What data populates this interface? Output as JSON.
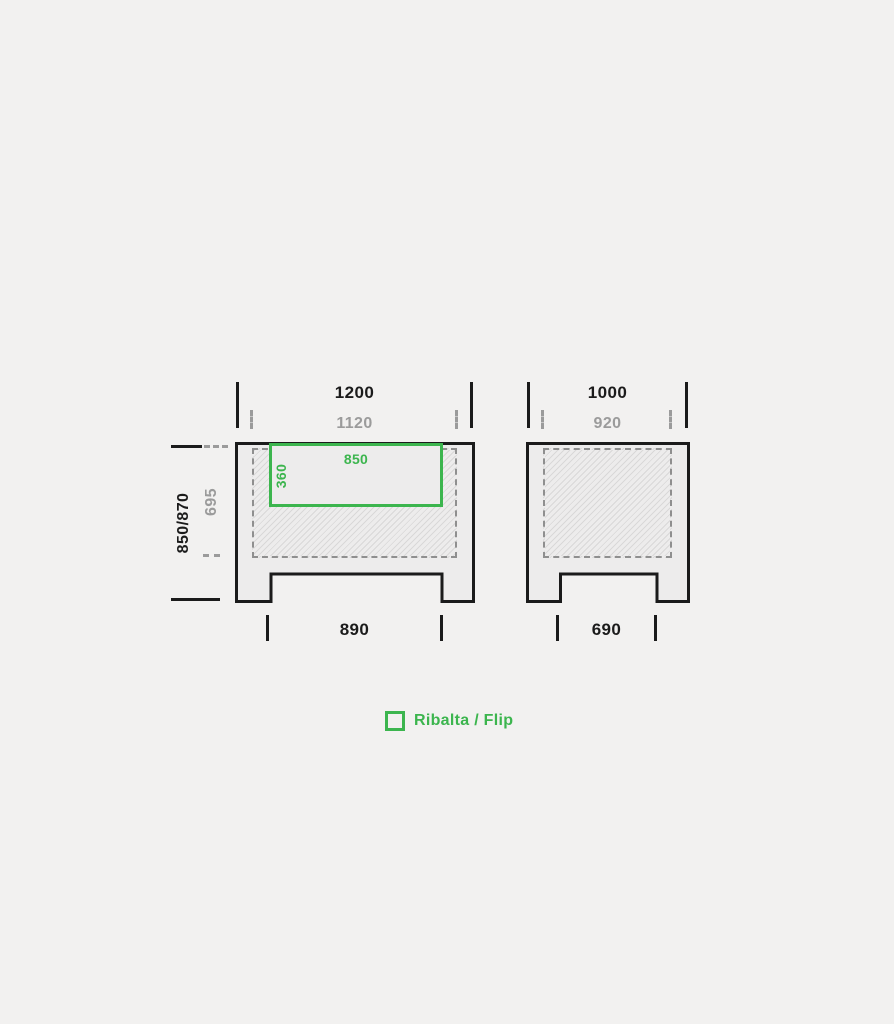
{
  "colors": {
    "background": "#f2f1f0",
    "shape_fill": "#edecec",
    "line_black": "#1b1b1b",
    "muted_gray": "#9b9b9b",
    "accent_green": "#3cb54e"
  },
  "front_view": {
    "outer_width": "1200",
    "inner_width": "1120",
    "height": "850/870",
    "inner_height": "695",
    "flip_width": "850",
    "flip_height": "360",
    "leg_span": "890"
  },
  "side_view": {
    "outer_width": "1000",
    "inner_width": "920",
    "leg_span": "690"
  },
  "legend": {
    "label": "Ribalta / Flip"
  }
}
